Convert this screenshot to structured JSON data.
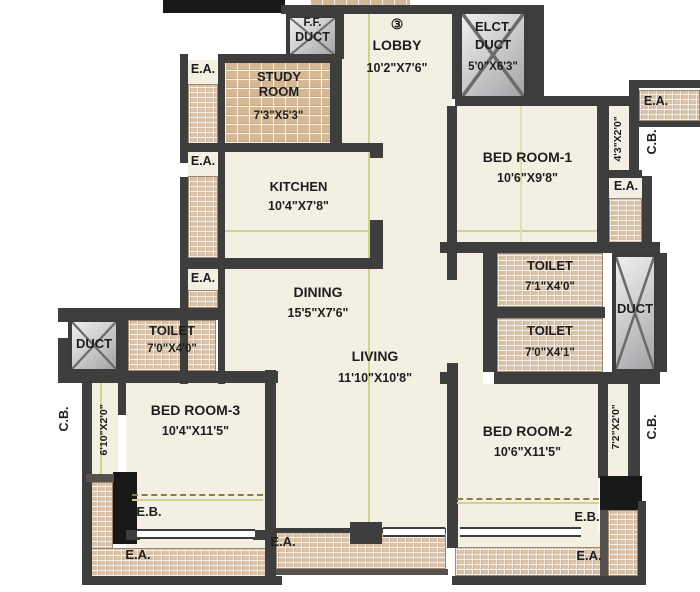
{
  "plan_title": "Apartment unit floor plan",
  "unit": {
    "number": "③"
  },
  "rooms": {
    "lobby": {
      "name": "LOBBY",
      "dims": "10'2\"X7'6\""
    },
    "study": {
      "name": "STUDY ROOM",
      "dims": "7'3\"X5'3\""
    },
    "kitchen": {
      "name": "KITCHEN",
      "dims": "10'4\"X7'8\""
    },
    "dining": {
      "name": "DINING",
      "dims": "15'5\"X7'6\""
    },
    "living": {
      "name": "LIVING",
      "dims": "11'10\"X10'8\""
    },
    "bed_room_1": {
      "name": "BED ROOM-1",
      "dims": "10'6\"X9'8\""
    },
    "bed_room_2": {
      "name": "BED ROOM-2",
      "dims": "10'6\"X11'5\""
    },
    "bed_room_3": {
      "name": "BED ROOM-3",
      "dims": "10'4\"X11'5\""
    },
    "toilet_right_top": {
      "name": "TOILET",
      "dims": "7'1\"X4'0\""
    },
    "toilet_right_bottom": {
      "name": "TOILET",
      "dims": "7'0\"X4'1\""
    },
    "toilet_left": {
      "name": "TOILET",
      "dims": "7'0\"X4'0\""
    },
    "ff_duct": {
      "line1": "F.F.",
      "line2": "DUCT"
    },
    "elct_duct": {
      "line1": "ELCT.",
      "line2": "DUCT",
      "dims": "5'0\"X6'3\""
    },
    "duct_left": {
      "name": "DUCT"
    },
    "duct_right": {
      "name": "DUCT"
    }
  },
  "annotations": {
    "ea": "E.A.",
    "eb": "E.B.",
    "cb": "C.B.",
    "ledge_left": "6'10\"X2'0\"",
    "ledge_top_right": "4'3\"X2'0\"",
    "ledge_bottom_right": "7'2\"X2'0\""
  },
  "colors": {
    "wall": "#3e3e3e",
    "floor": "#f3efe2",
    "tile": "#d9c2a7",
    "duct_fill": "#d9d9db",
    "grid_line": "#cfd28a",
    "background": "#ffffff"
  }
}
